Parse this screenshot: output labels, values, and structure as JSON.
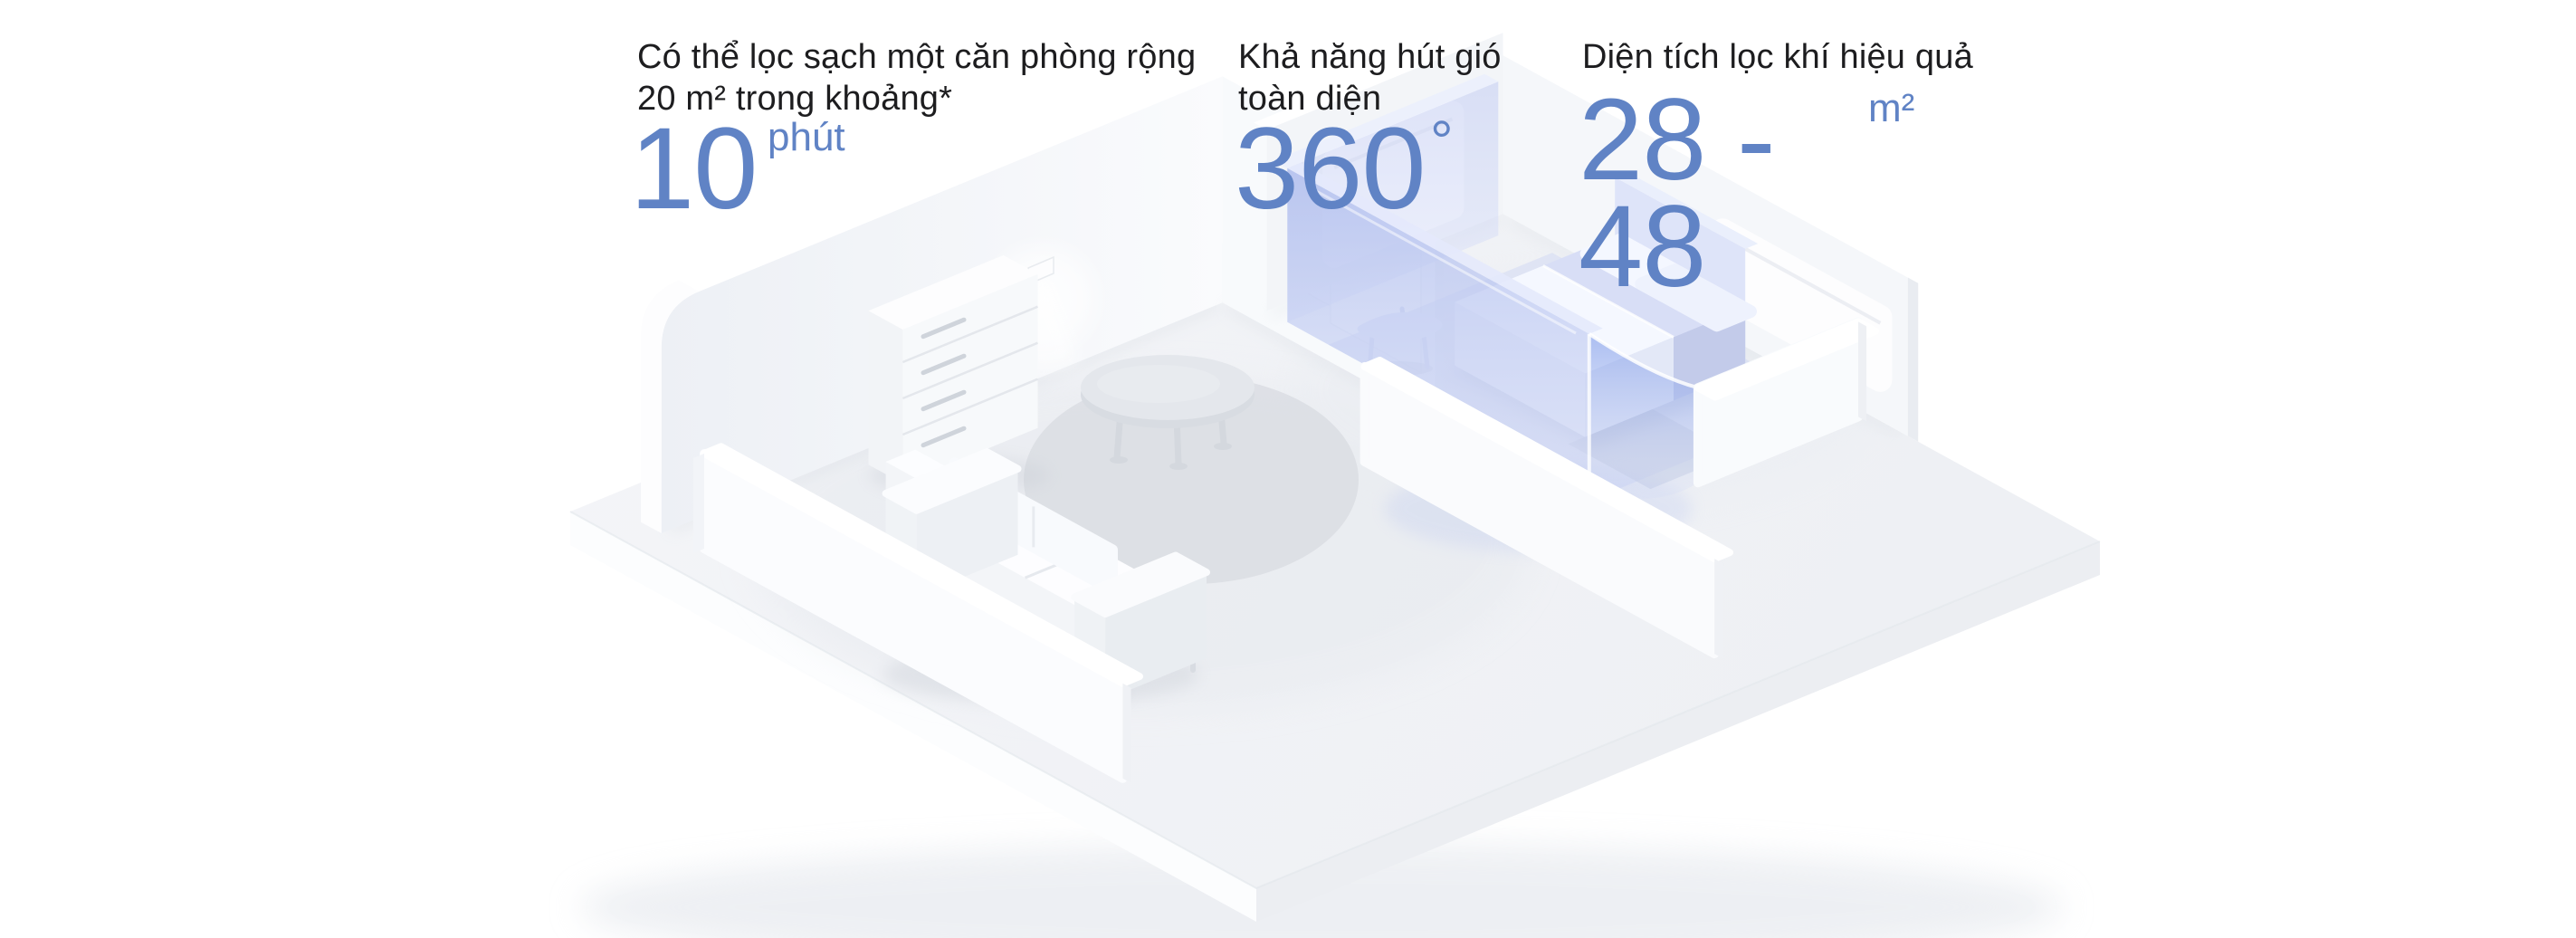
{
  "colors": {
    "background": "#ffffff",
    "accent_blue": "#6083c5",
    "heading_text": "#1d1d1f",
    "zone_blue": "#c9d2f2"
  },
  "stats": [
    {
      "label_line1": "Có thể lọc sạch một căn phòng rộng",
      "label_line2": "20 m² trong khoảng*",
      "value": "10",
      "unit": "phút"
    },
    {
      "label_line1": "Khả năng hút gió",
      "label_line2": "toàn diện",
      "value": "360",
      "unit": "°"
    },
    {
      "label_line1": "Diện tích lọc khí hiệu quả",
      "label_line2": "",
      "value": "28 - 48",
      "unit": "m²"
    }
  ]
}
